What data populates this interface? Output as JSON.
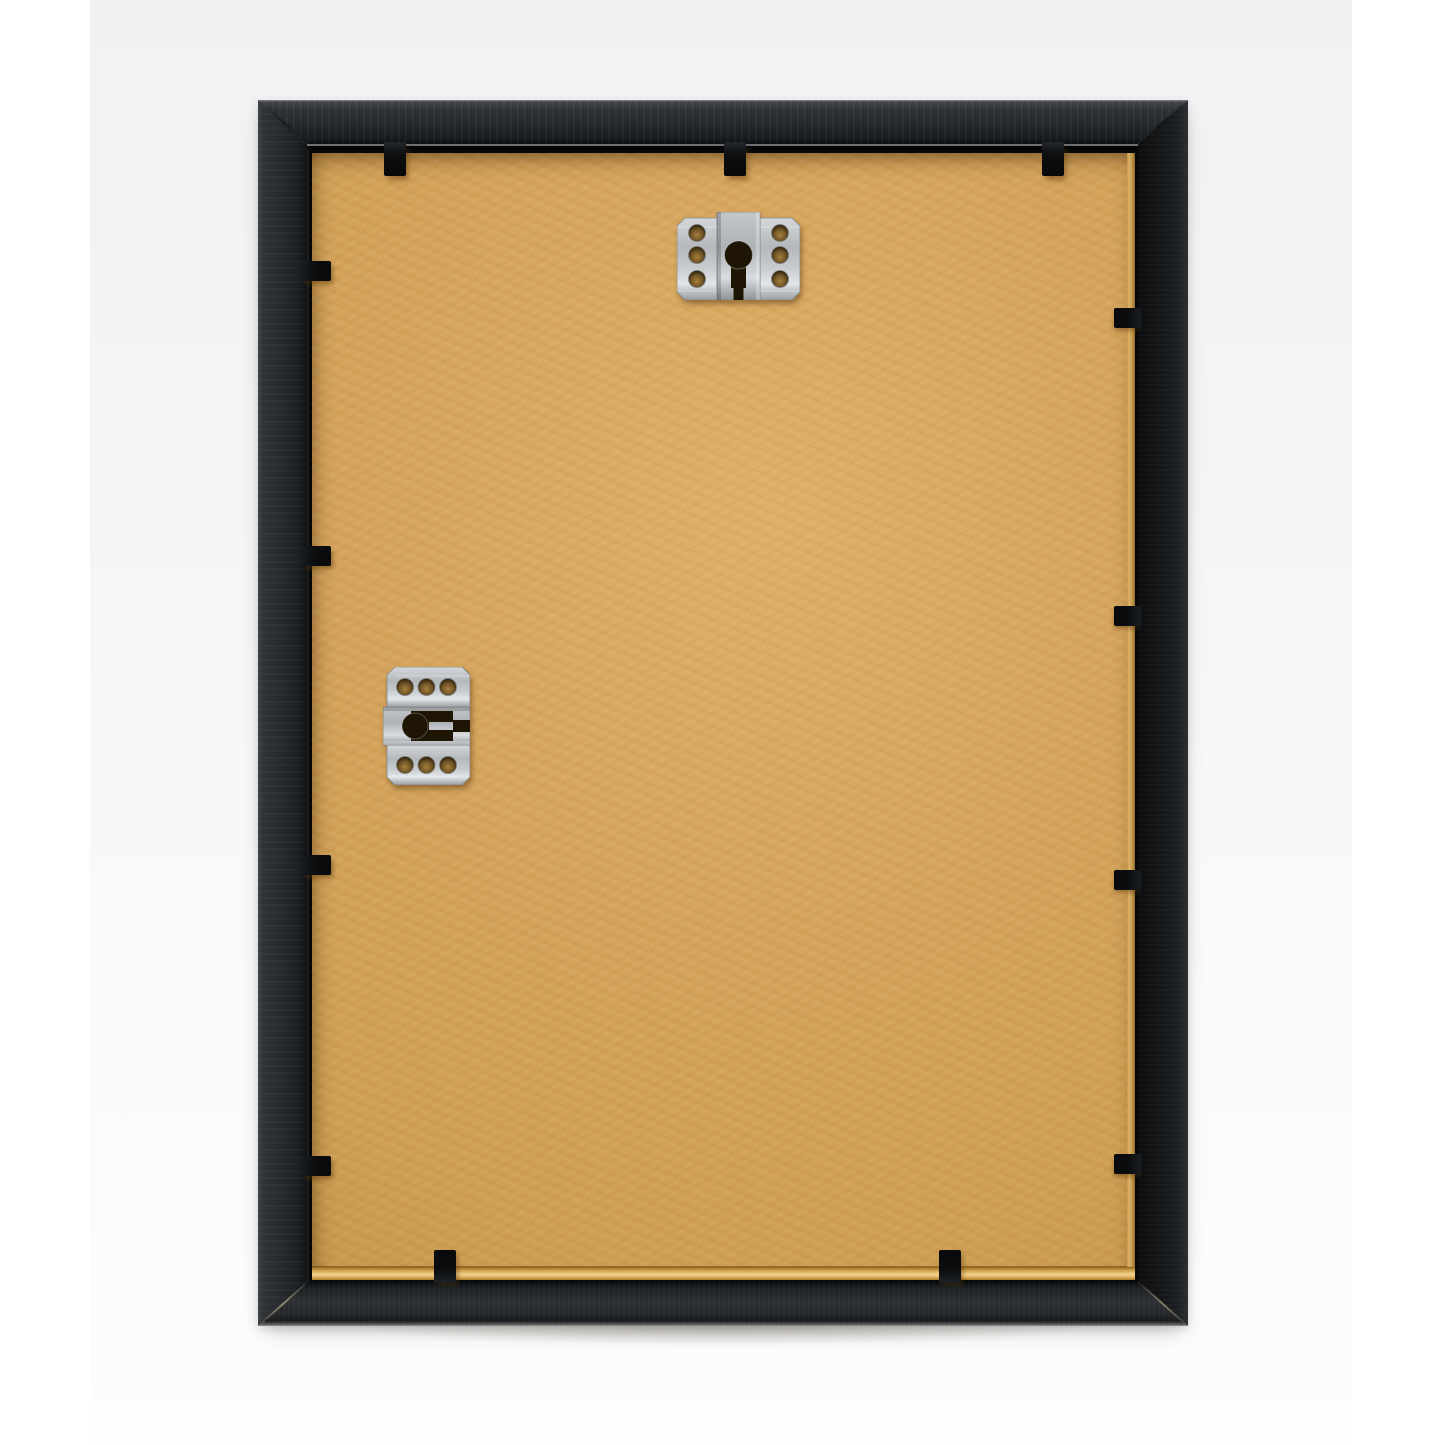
{
  "scene": {
    "type": "product-photo",
    "subject": "Back view of a black picture frame: tan MDF backing board held by black flexi tabs, with two silver keyhole hanger plates (one for portrait, one for landscape hanging)",
    "palette": {
      "page_bg": "#ffffff",
      "photo_bg_top": "#f1f1f3",
      "photo_bg_bottom": "#fdfdfe",
      "frame_black": "#202427",
      "frame_edge_highlight": "#888c8e",
      "rebate_dark": "#08090b",
      "backing_tan": "#d5a45c",
      "backing_vignette": "#b98a43",
      "backing_edge_gold": "#eac173",
      "tab_black": "#0b0d0f",
      "metal_silver": "#b4b8bb",
      "metal_highlight": "#e2e6e8",
      "metal_shadow": "#8f9396",
      "hanger_hole_tan": "#6f5426",
      "keyhole_dark": "#1f1505"
    },
    "layout": {
      "photo_left": 90,
      "photo_width": 1262,
      "frame_left": 258,
      "frame_top": 100,
      "frame_width": 930,
      "frame_height": 1226,
      "rail_top": 44,
      "rail_left": 49,
      "rail_right": 50,
      "rail_bottom": 44
    },
    "hangers": [
      {
        "name": "keyhole-hanger-plate-top",
        "x": 419,
        "y": 112,
        "width": 123,
        "height": 88,
        "orientation": "slot-down"
      },
      {
        "name": "keyhole-hanger-plate-side",
        "x": 125,
        "y": 567,
        "width": 87,
        "height": 118,
        "orientation": "slot-right"
      }
    ],
    "tabs": {
      "top_x": [
        137,
        477,
        795
      ],
      "bottom_x": [
        187,
        692
      ],
      "left_y": [
        171,
        456,
        765,
        1066
      ],
      "right_y": [
        218,
        516,
        780,
        1064
      ]
    }
  }
}
